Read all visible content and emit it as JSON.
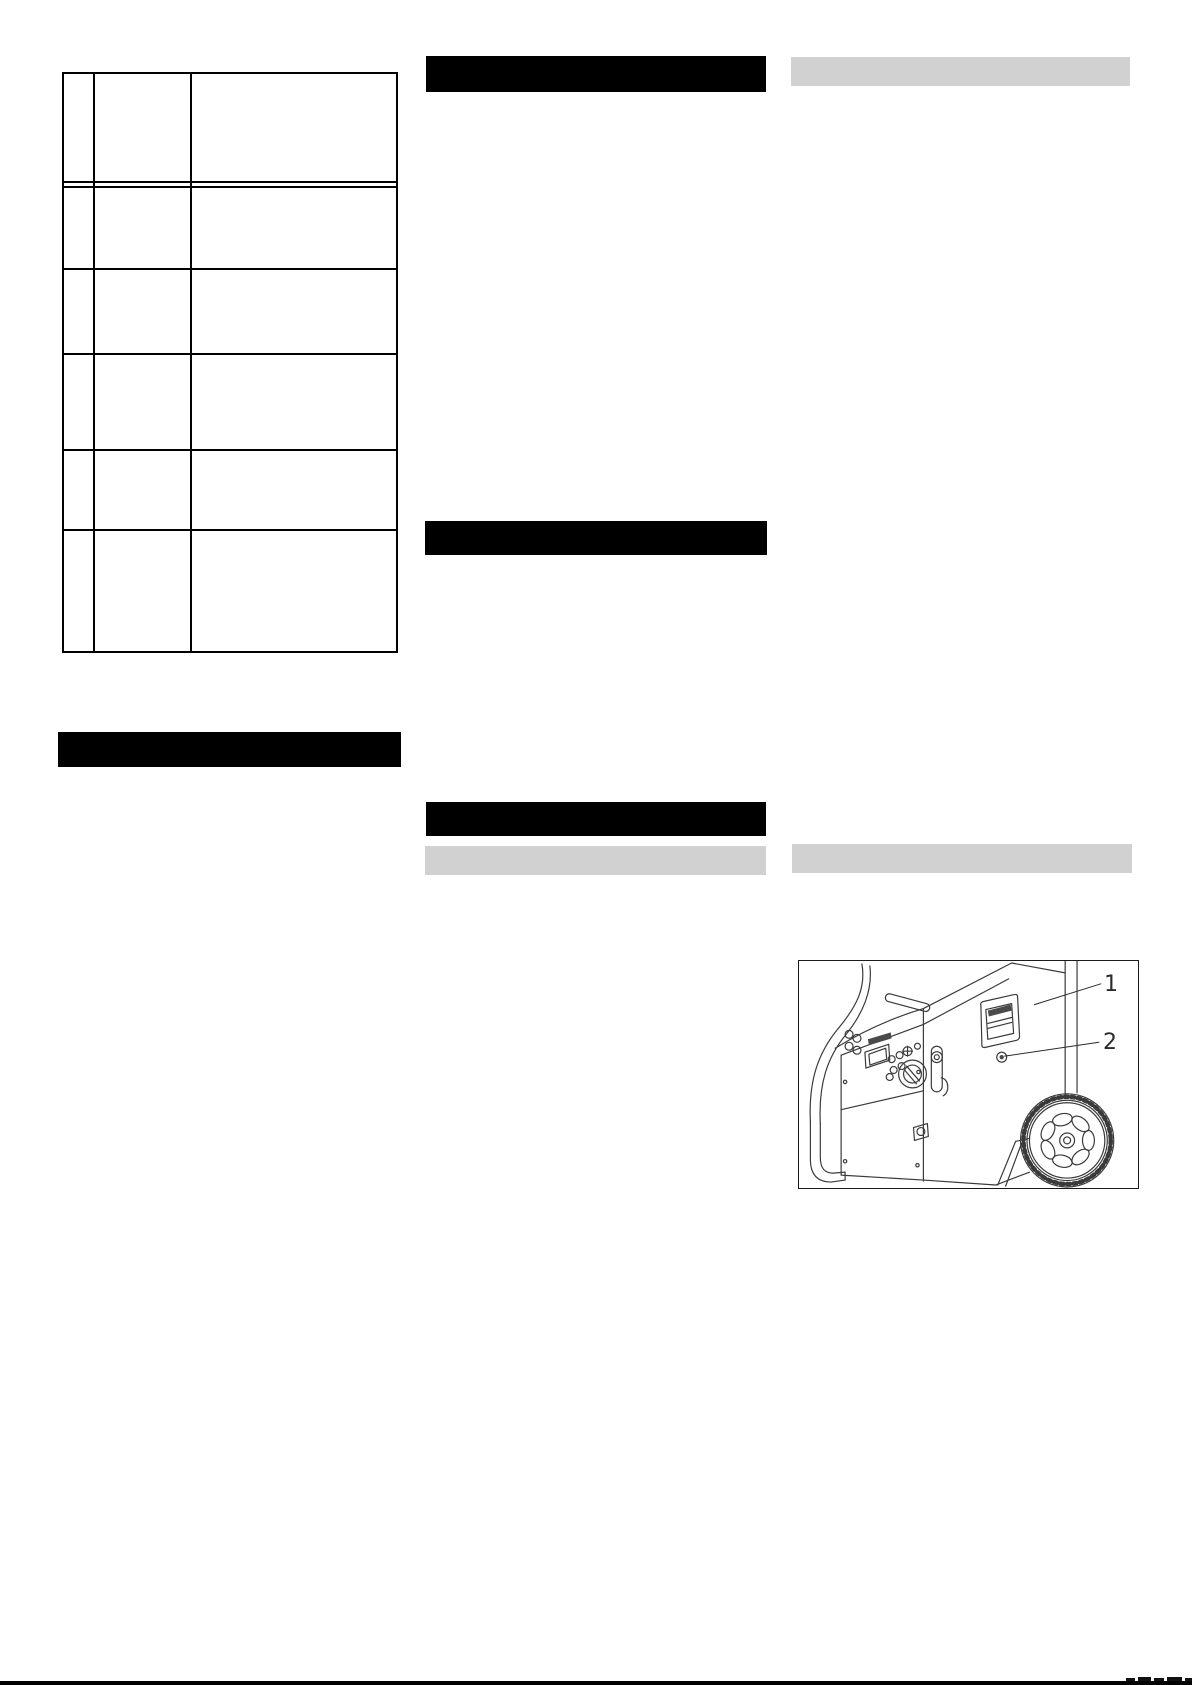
{
  "page": {
    "width_px": 1192,
    "height_px": 1685,
    "background": "#ffffff"
  },
  "colors": {
    "bar_black": "#000000",
    "bar_gray": "#d1d1d1",
    "table_border": "#000000",
    "drawing": "#3a3a3a",
    "page_bg": "#ffffff",
    "footer_rule": "#000000"
  },
  "left_column": {
    "spec_table": {
      "columns": 3,
      "rows": 6,
      "double_rule_after_row": 1
    },
    "heading_bar_label": ""
  },
  "middle_column": {
    "heading_bar_labels": [
      "",
      "",
      ""
    ],
    "subheading_bar_label": ""
  },
  "right_column": {
    "subheading_bar_labels": [
      "",
      ""
    ],
    "figure": {
      "callouts": [
        {
          "label": "1"
        },
        {
          "label": "2"
        }
      ]
    }
  },
  "footer": {
    "rule": "full-width"
  }
}
